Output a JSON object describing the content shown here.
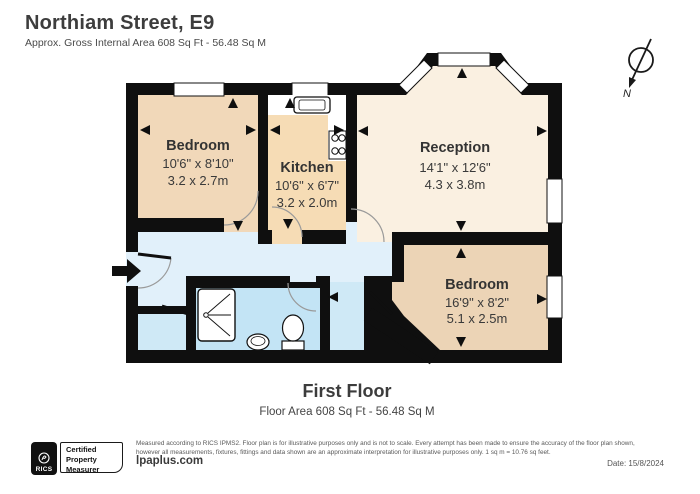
{
  "header": {
    "title": "Northiam Street, E9",
    "subtitle": "Approx. Gross Internal Area 608 Sq Ft - 56.48 Sq M"
  },
  "compass": {
    "label": "N"
  },
  "rooms": {
    "bedroom1": {
      "name": "Bedroom",
      "imperial": "10'6\" x 8'10\"",
      "metric": "3.2 x 2.7m"
    },
    "kitchen": {
      "name": "Kitchen",
      "imperial": "10'6\" x 6'7\"",
      "metric": "3.2 x 2.0m"
    },
    "reception": {
      "name": "Reception",
      "imperial": "14'1\" x 12'6\"",
      "metric": "4.3 x 3.8m"
    },
    "bedroom2": {
      "name": "Bedroom",
      "imperial": "16'9\" x 8'2\"",
      "metric": "5.1 x 2.5m"
    }
  },
  "floor": {
    "name": "First Floor",
    "area": "Floor Area 608 Sq Ft - 56.48 Sq M"
  },
  "footer": {
    "rics": "RICS",
    "badge_lines": [
      "Certified",
      "Property",
      "Measurer"
    ],
    "disclaimer1": "Measured according to RICS IPMS2. Floor plan is for illustrative purposes only and is not to scale. Every attempt has been made to ensure the accuracy of the floor plan shown,",
    "disclaimer2": "however all measurements, fixtures, fittings and data shown are an approximate interpretation for illustrative purposes only. 1 sq m = 10.76 sq feet.",
    "website": "lpaplus.com",
    "date": "Date: 15/8/2024"
  },
  "colors": {
    "wall": "#0f0f0f",
    "bedroom_fill": "#f1d8b9",
    "kitchen_fill": "#f6dcb5",
    "reception_fill": "#faf0e1",
    "hallway_fill": "#e1f0fa",
    "bathroom_fill": "#c3e4f5",
    "closet_fill": "#cfe9f6"
  }
}
